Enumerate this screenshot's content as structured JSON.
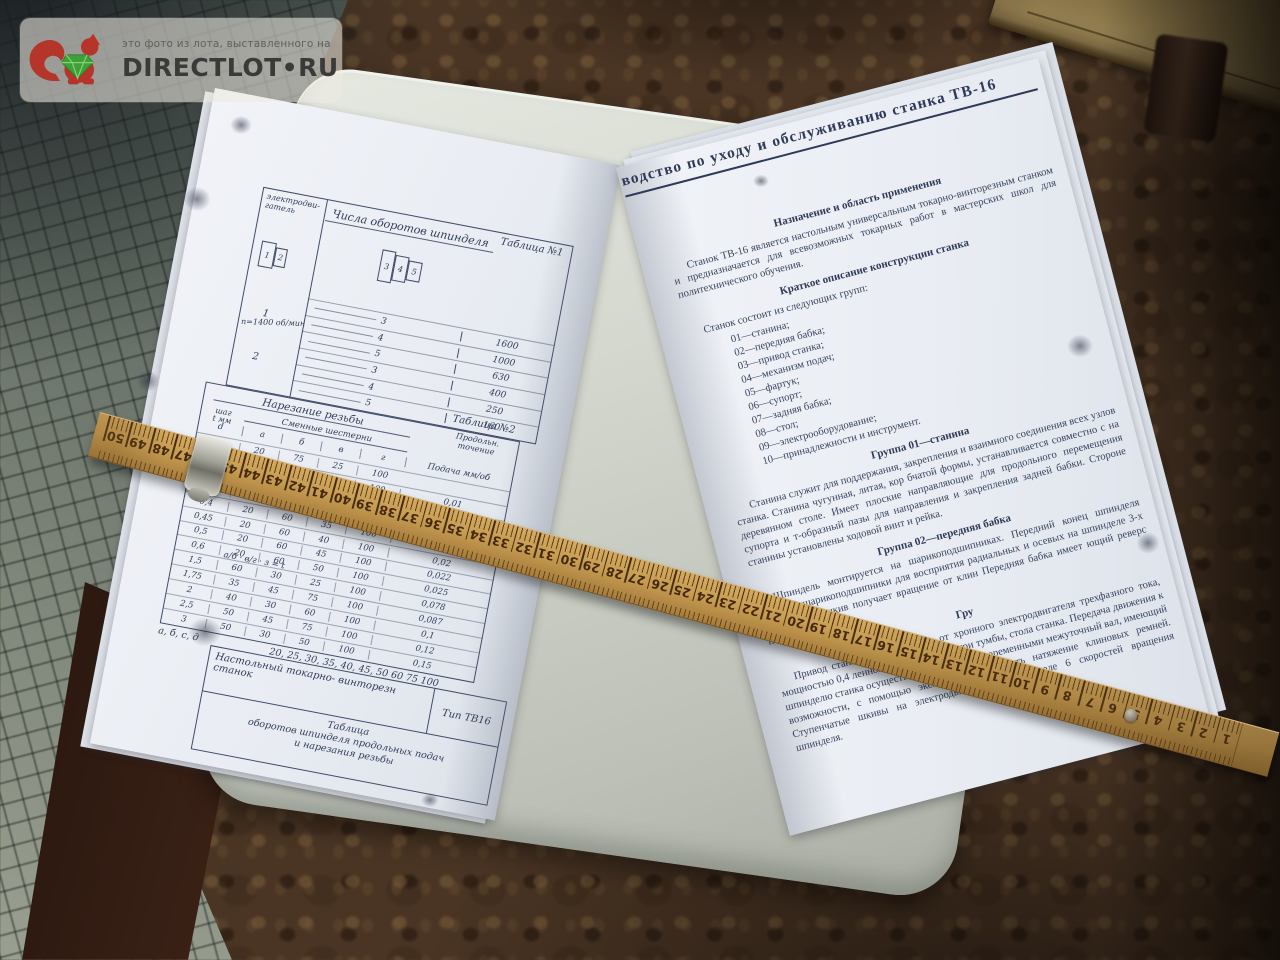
{
  "watermark": {
    "note": "это фото из лота, выставленного на",
    "brand": "DIRECTLOT•RU"
  },
  "left_page": {
    "table1": {
      "caption": "Таблица №1",
      "title": "Числа оборотов шпинделя",
      "col_motor_1": "электродви-",
      "col_motor_2": "гатель",
      "motor_note": "n=1400 об/мин",
      "motor_pulley_labels": [
        "1",
        "2"
      ],
      "spindle_pulley_labels": [
        "3",
        "4",
        "5"
      ],
      "motor_row_1": "1",
      "motor_row_2": "2",
      "rows": [
        [
          "3",
          "1600"
        ],
        [
          "4",
          "1000"
        ],
        [
          "5",
          "630"
        ],
        [
          "3",
          "400"
        ],
        [
          "4",
          "250"
        ],
        [
          "5",
          "160"
        ]
      ]
    },
    "table2": {
      "caption": "Таблица №2",
      "title": "Нарезание резьбы",
      "col_step_1": "шаг",
      "col_step_2": "t мм",
      "col_gears": "Сменные шестерни",
      "gear_letters": [
        "а",
        "б",
        "в",
        "г"
      ],
      "col_feed_1": "Продольн.",
      "col_feed_2": "точение",
      "col_d": "d",
      "col_feed_unit": "Подача мм/об",
      "rows": [
        [
          "0,2",
          "20",
          "75",
          "25",
          "100",
          ""
        ],
        [
          "0,25",
          "25",
          "60",
          "25",
          "100",
          "0,01"
        ],
        [
          "0,3",
          "20",
          "60",
          "20",
          "100",
          "0,012"
        ],
        [
          "0,35",
          "20",
          "60",
          "30",
          "100",
          "0,013"
        ],
        [
          "0,4",
          "20",
          "60",
          "35",
          "100",
          "0,017"
        ],
        [
          "0,45",
          "20",
          "60",
          "40",
          "100",
          "0,02"
        ],
        [
          "0,5",
          "20",
          "60",
          "45",
          "100",
          "0,022"
        ],
        [
          "0,6",
          "20",
          "60",
          "50",
          "100",
          "0,025"
        ],
        [
          "1,5",
          "60",
          "30",
          "25",
          "100",
          "0,078"
        ],
        [
          "1,75",
          "35",
          "45",
          "75",
          "100",
          "0,087"
        ],
        [
          "2",
          "40",
          "30",
          "60",
          "100",
          "0,1"
        ],
        [
          "2,5",
          "50",
          "45",
          "75",
          "100",
          "0,12"
        ],
        [
          "3",
          "50",
          "30",
          "50",
          "100",
          "0,15"
        ]
      ],
      "formula": "а/б · в/г · з = t",
      "sketch_label": "а",
      "footer_label": "а, б, с, д",
      "footer_values": "20, 25, 30, 35, 40, 45, 50 60 75 100"
    },
    "title_block": {
      "line1": "Настольный токарно- винторезн станок",
      "type": "Тип ТВ16",
      "caption": "Таблица",
      "line2": "оборотов шпинделя продольных подач",
      "line3": "и нарезания резьбы"
    }
  },
  "right_page": {
    "title": "водство по уходу и обслуживанию станка ТВ-16",
    "s1_heading": "Назначение и область применения",
    "s1_p": "Станок ТВ-16 является настольным универсальным токарно-винторезным станком и предназначается для всевозможных токарных работ в мастерских школ для политехнического обучения.",
    "s2_heading": "Краткое описание конструкции станка",
    "s2_intro": "Станок состоит из следующих групп:",
    "groups": [
      "01—станина;",
      "02—передняя бабка;",
      "03—привод станка;",
      "04—механизм подач;",
      "05—фартук;",
      "06—супорт;",
      "07—задняя бабка;",
      "08—стол;",
      "09—электрооборудование;",
      "10—принадлежности и инструмент."
    ],
    "g01_heading": "Группа 01—станина",
    "g01_p": "Станина служит для поддержания, закрепления и взаимного соединения всех узлов станка. Станина чугунная, литая, кор бчатой формы, устанавливается совместно с на деревянном столе. Имеет плоские направляющие для продольного перемещения супорта и т-образный пазы для направления и закрепления задней бабки. Стороне станины установлены ходовой винт и рейка.",
    "g02_heading": "Группа 02—передняя бабка",
    "g02_p": "Шпиндель монтируется на шарикоподшипниках. Передний конец шпинделя опорные шарикоподшипники для восприятия радиальных и осевых на шпинделе 3-х ступенчатый шкив получает вращение от клин Передняя бабка имеет ющий реверс подачи.",
    "g03_heading": "Гру",
    "g03_p": "Привод станка осуществляется от хронного электродвигателя трехфазного тока, мощностью 0,4 ленного на салазках внутри тумбы, стола станка. Передача движения к шпинделю станка осуществляется двумя клиноременными межуточный вал, имеющий возможности, с помощью эксцентри производить натяжение клиновых ремней. Ступенчатые шкивы на электродвигателе и шпинделе 6 скоростей вращения шпинделя."
  },
  "ruler": {
    "numbers": [
      50,
      49,
      48,
      47,
      46,
      45,
      44,
      43,
      42,
      41,
      40,
      39,
      38,
      37,
      36,
      35,
      34,
      33,
      32,
      31,
      30,
      29,
      28,
      27,
      26,
      25,
      24,
      23,
      22,
      21,
      20,
      19,
      18,
      17,
      16,
      15,
      14,
      13,
      12,
      11,
      10,
      9,
      8,
      7,
      6,
      5,
      4,
      3,
      2,
      1
    ]
  },
  "colors": {
    "brand_text": "#3a3a38",
    "squirrel_red": "#b5352a",
    "gem_green": "#3f9f38",
    "page_ink": "#35445f",
    "ruler_wood": "#c69c52",
    "floor_brown": "#4a3524",
    "tile_gray": "#6e7870",
    "table_gray": "#d3d7cd"
  }
}
